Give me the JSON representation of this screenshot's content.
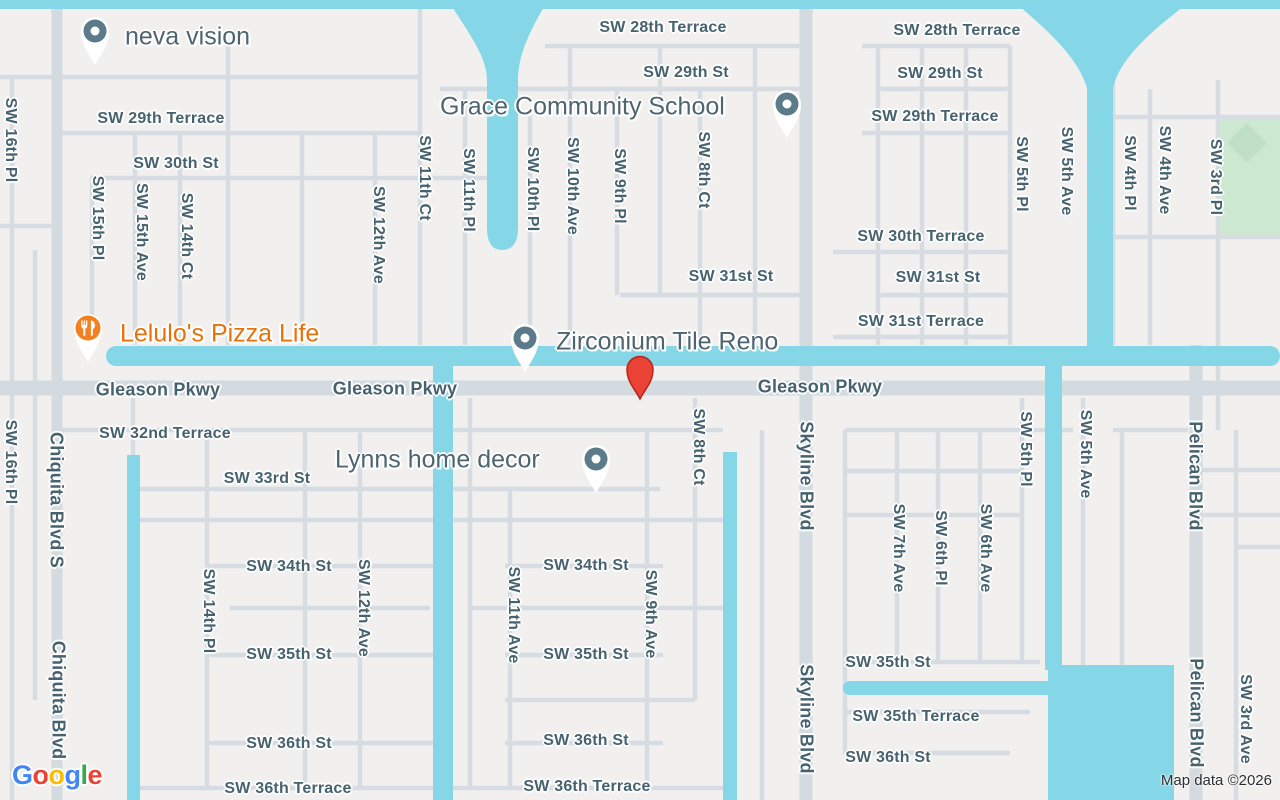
{
  "map": {
    "attribution": "Map data ©2026",
    "logo_letters": [
      "G",
      "o",
      "o",
      "g",
      "l",
      "e"
    ],
    "colors": {
      "land": "#f1f0ef",
      "water": "#85d7e8",
      "road": "#d7dce2",
      "park": "#cde8d0",
      "street_text": "#47626f",
      "poi_text": "#4e6470",
      "poi_orange": "#e8710a",
      "poi_marker_slate": "#5b7a8a",
      "poi_marker_orange": "#f4801f",
      "destination_pin_red": "#ea4335"
    },
    "destination_pin": {
      "x": 640,
      "y": 400
    },
    "pois": [
      {
        "name": "neva vision",
        "label_x": 125,
        "label_y": 37,
        "marker_x": 95,
        "marker_y": 31,
        "type": "shop"
      },
      {
        "name": "Grace Community School",
        "label_x": 440,
        "label_y": 107,
        "marker_x": 787,
        "marker_y": 104,
        "type": "school"
      },
      {
        "name": "Lelulo's Pizza Life",
        "label_x": 120,
        "label_y": 334,
        "marker_x": 88,
        "marker_y": 328,
        "type": "restaurant"
      },
      {
        "name": "Zirconium Tile Reno",
        "label_x": 556,
        "label_y": 342,
        "marker_x": 525,
        "marker_y": 338,
        "type": "shop"
      },
      {
        "name": "Lynns home decor",
        "label_x": 335,
        "label_y": 460,
        "marker_x": 596,
        "marker_y": 459,
        "type": "shop"
      }
    ],
    "streets": [
      {
        "text": "SW 28th Terrace",
        "x": 663,
        "y": 28
      },
      {
        "text": "SW 28th Terrace",
        "x": 957,
        "y": 31
      },
      {
        "text": "SW 29th St",
        "x": 686,
        "y": 73
      },
      {
        "text": "SW 29th St",
        "x": 940,
        "y": 74
      },
      {
        "text": "SW 29th Terrace",
        "x": 161,
        "y": 119
      },
      {
        "text": "SW 29th Terrace",
        "x": 935,
        "y": 117
      },
      {
        "text": "SW 30th St",
        "x": 176,
        "y": 164
      },
      {
        "text": "SW 30th Terrace",
        "x": 921,
        "y": 237
      },
      {
        "text": "SW 31st St",
        "x": 731,
        "y": 277
      },
      {
        "text": "SW 31st St",
        "x": 938,
        "y": 278
      },
      {
        "text": "SW 31st Terrace",
        "x": 921,
        "y": 322
      },
      {
        "text": "Gleason Pkwy",
        "x": 158,
        "y": 390,
        "major": true
      },
      {
        "text": "Gleason Pkwy",
        "x": 395,
        "y": 389,
        "major": true
      },
      {
        "text": "Gleason Pkwy",
        "x": 820,
        "y": 387,
        "major": true
      },
      {
        "text": "SW 32nd Terrace",
        "x": 165,
        "y": 434
      },
      {
        "text": "SW 33rd St",
        "x": 267,
        "y": 479
      },
      {
        "text": "SW 34th St",
        "x": 289,
        "y": 567
      },
      {
        "text": "SW 34th St",
        "x": 586,
        "y": 566
      },
      {
        "text": "SW 35th St",
        "x": 289,
        "y": 655
      },
      {
        "text": "SW 35th St",
        "x": 586,
        "y": 655
      },
      {
        "text": "SW 35th St",
        "x": 888,
        "y": 663
      },
      {
        "text": "SW 35th Terrace",
        "x": 916,
        "y": 717
      },
      {
        "text": "SW 36th St",
        "x": 289,
        "y": 744
      },
      {
        "text": "SW 36th St",
        "x": 586,
        "y": 741
      },
      {
        "text": "SW 36th St",
        "x": 888,
        "y": 758
      },
      {
        "text": "SW 36th Terrace",
        "x": 288,
        "y": 789
      },
      {
        "text": "SW 36th Terrace",
        "x": 587,
        "y": 787
      },
      {
        "text": "SW 16th Pl",
        "x": 10,
        "y": 140,
        "v": true
      },
      {
        "text": "SW 16th Pl",
        "x": 10,
        "y": 462,
        "v": true
      },
      {
        "text": "SW 15th Pl",
        "x": 97,
        "y": 218,
        "v": true
      },
      {
        "text": "SW 15th Ave",
        "x": 141,
        "y": 232,
        "v": true
      },
      {
        "text": "SW 14th Ct",
        "x": 186,
        "y": 236,
        "v": true
      },
      {
        "text": "SW 12th Ave",
        "x": 378,
        "y": 235,
        "v": true
      },
      {
        "text": "SW 11th Ct",
        "x": 424,
        "y": 178,
        "v": true
      },
      {
        "text": "SW 11th Pl",
        "x": 468,
        "y": 190,
        "v": true
      },
      {
        "text": "SW 10th Pl",
        "x": 532,
        "y": 189,
        "v": true
      },
      {
        "text": "SW 10th Ave",
        "x": 572,
        "y": 186,
        "v": true
      },
      {
        "text": "SW 9th Pl",
        "x": 619,
        "y": 186,
        "v": true
      },
      {
        "text": "SW 8th Ct",
        "x": 703,
        "y": 170,
        "v": true
      },
      {
        "text": "SW 5th Pl",
        "x": 1021,
        "y": 174,
        "v": true
      },
      {
        "text": "SW 5th Ave",
        "x": 1066,
        "y": 171,
        "v": true
      },
      {
        "text": "SW 4th Pl",
        "x": 1129,
        "y": 173,
        "v": true
      },
      {
        "text": "SW 4th Ave",
        "x": 1164,
        "y": 170,
        "v": true
      },
      {
        "text": "SW 3rd Pl",
        "x": 1215,
        "y": 177,
        "v": true
      },
      {
        "text": "Chiquita Blvd S",
        "x": 56,
        "y": 500,
        "v": true,
        "major": true
      },
      {
        "text": "Chiquita Blvd",
        "x": 58,
        "y": 700,
        "v": true,
        "major": true
      },
      {
        "text": "SW 14th Pl",
        "x": 208,
        "y": 611,
        "v": true
      },
      {
        "text": "SW 12th Ave",
        "x": 363,
        "y": 608,
        "v": true
      },
      {
        "text": "SW 11th Ave",
        "x": 513,
        "y": 615,
        "v": true
      },
      {
        "text": "SW 9th Ave",
        "x": 650,
        "y": 614,
        "v": true
      },
      {
        "text": "SW 8th Ct",
        "x": 698,
        "y": 447,
        "v": true
      },
      {
        "text": "Skyline Blvd",
        "x": 806,
        "y": 476,
        "v": true,
        "major": true
      },
      {
        "text": "Skyline Blvd",
        "x": 806,
        "y": 719,
        "v": true,
        "major": true
      },
      {
        "text": "SW 7th Ave",
        "x": 898,
        "y": 548,
        "v": true
      },
      {
        "text": "SW 6th Pl",
        "x": 940,
        "y": 548,
        "v": true
      },
      {
        "text": "SW 6th Ave",
        "x": 985,
        "y": 548,
        "v": true
      },
      {
        "text": "SW 5th Pl",
        "x": 1025,
        "y": 449,
        "v": true
      },
      {
        "text": "SW 5th Ave",
        "x": 1085,
        "y": 454,
        "v": true
      },
      {
        "text": "Pelican Blvd",
        "x": 1195,
        "y": 476,
        "v": true,
        "major": true
      },
      {
        "text": "Pelican Blvd",
        "x": 1196,
        "y": 713,
        "v": true,
        "major": true
      },
      {
        "text": "SW 3rd Ave",
        "x": 1245,
        "y": 719,
        "v": true
      }
    ]
  }
}
